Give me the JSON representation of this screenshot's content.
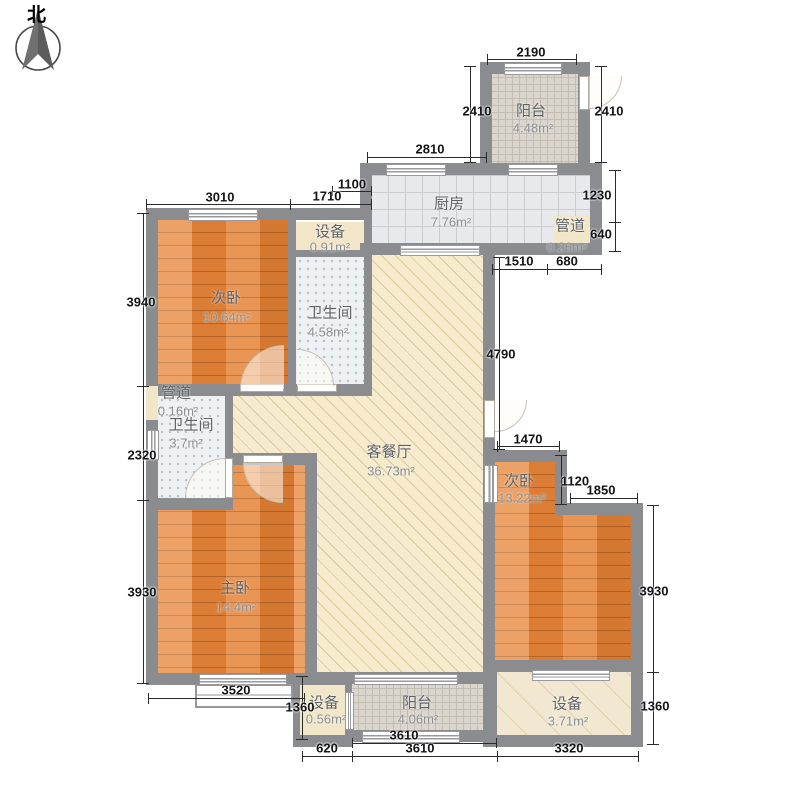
{
  "compass_label": "北",
  "rooms": {
    "balcony_top": {
      "name": "阳台",
      "area": "4.48m²"
    },
    "kitchen": {
      "name": "厨房",
      "area": "7.76m²"
    },
    "duct_top": {
      "name": "管道",
      "area": "0.26m²"
    },
    "bedroom_tl": {
      "name": "次卧",
      "area": "10.64m²"
    },
    "equip_top": {
      "name": "设备",
      "area": "0.91m²"
    },
    "bath_1": {
      "name": "卫生间",
      "area": "4.58m²"
    },
    "living": {
      "name": "客餐厅",
      "area": "36.73m²"
    },
    "duct_left": {
      "name": "管道",
      "area": "0.16m²"
    },
    "bath_2": {
      "name": "卫生间",
      "area": "3.7m²"
    },
    "master": {
      "name": "主卧",
      "area": "14.4m²"
    },
    "bedroom_r": {
      "name": "次卧",
      "area": "13.22m²"
    },
    "equip_bl": {
      "name": "设备",
      "area": "0.56m²"
    },
    "balcony_btm": {
      "name": "阳台",
      "area": "4.06m²"
    },
    "equip_br": {
      "name": "设备",
      "area": "3.71m²"
    }
  },
  "dims": {
    "d2190": "2190",
    "d2410l": "2410",
    "d2410r": "2410",
    "d2810": "2810",
    "d1100": "1100",
    "d1710": "1710",
    "d3010": "3010",
    "d1230": "1230",
    "d640": "640",
    "d1510": "1510",
    "d680": "680",
    "d3940": "3940",
    "d2320": "2320",
    "d3930l": "3930",
    "d4790": "4790",
    "d1470": "1470",
    "d1120": "1120",
    "d1850": "1850",
    "d3930r": "3930",
    "d1360r": "1360",
    "d3520": "3520",
    "d1360l": "1360",
    "d620": "620",
    "d3610a": "3610",
    "d3610b": "3610",
    "d3320": "3320"
  }
}
